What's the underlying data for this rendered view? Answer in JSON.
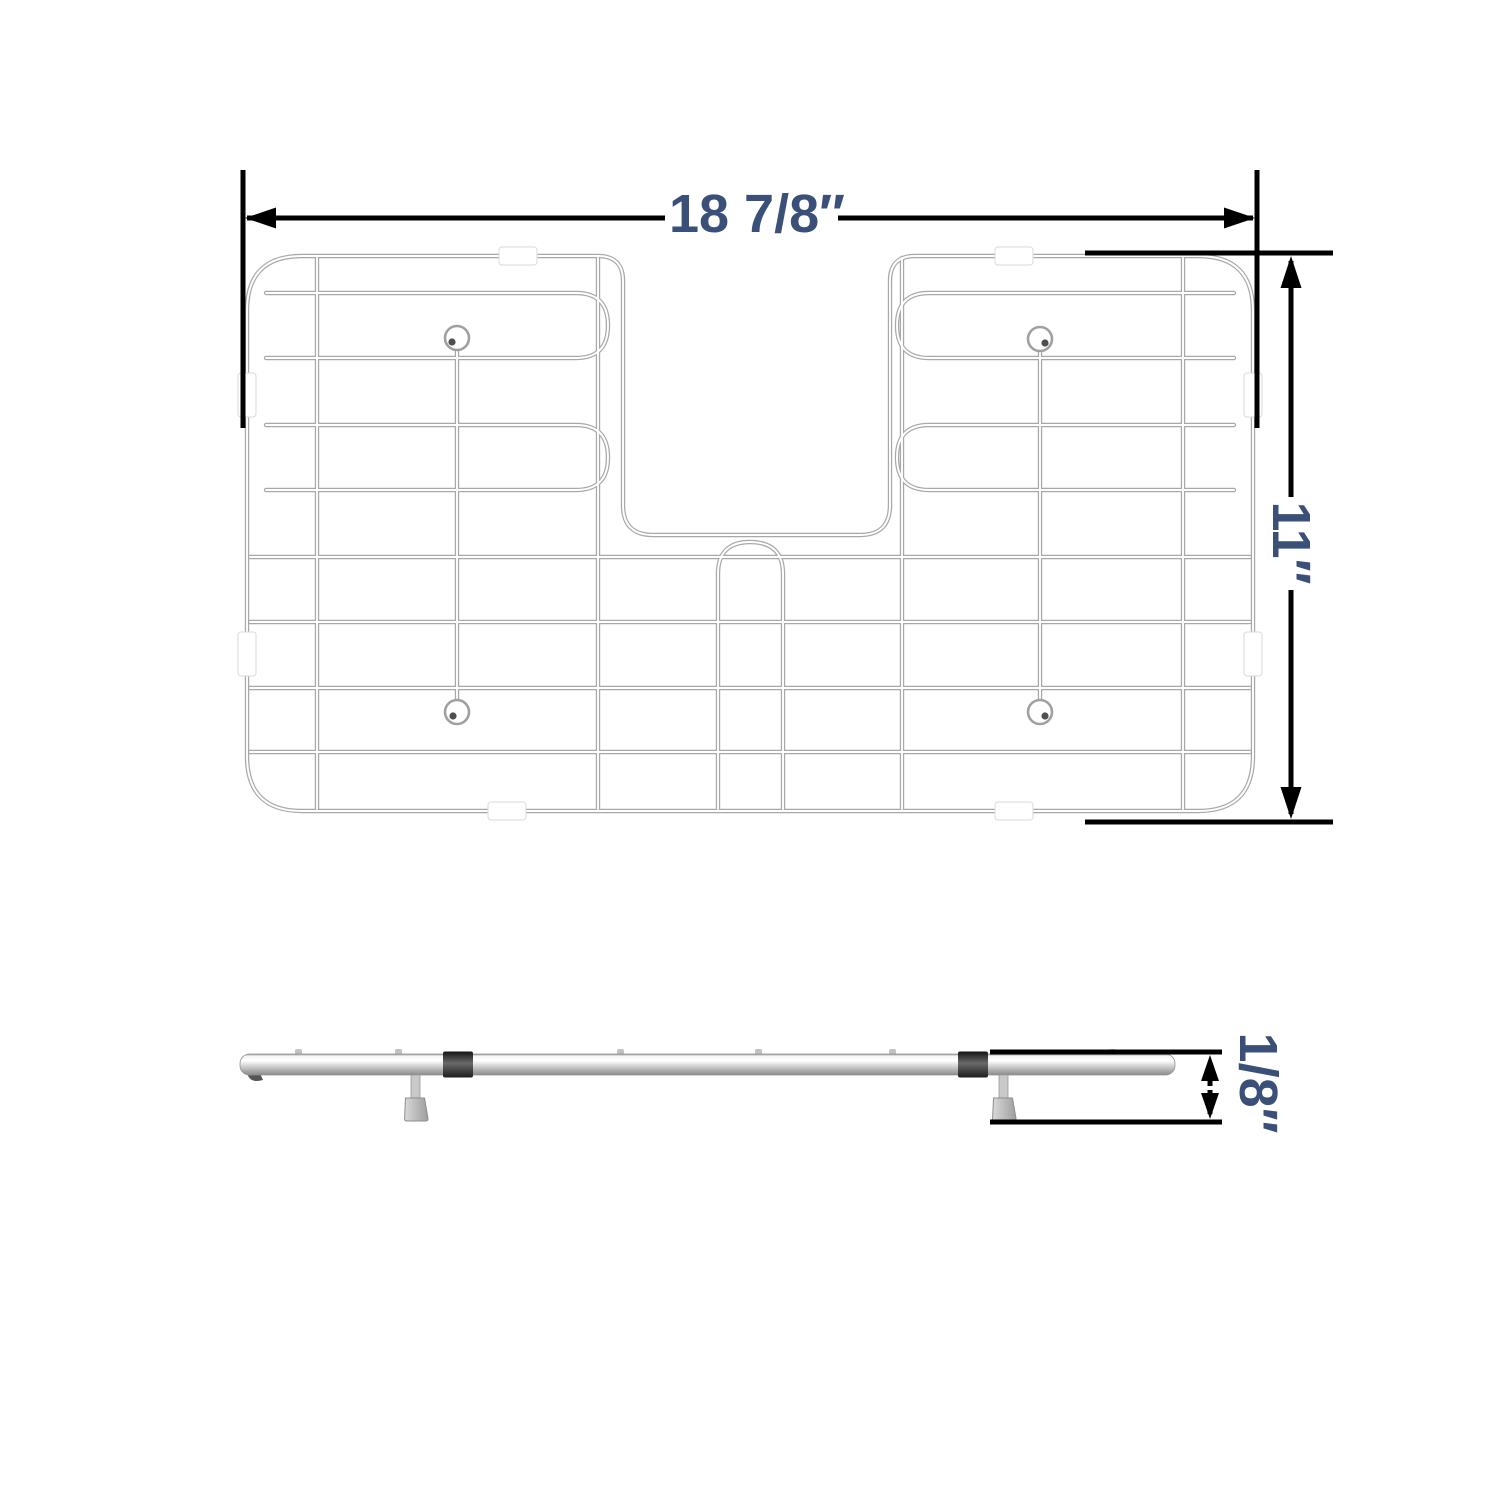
{
  "labels": {
    "width": "18 7/8″",
    "height": "11″",
    "thickness": "1/8″"
  },
  "colors": {
    "dimension_text": "#3a5078",
    "dimension_line": "#000000",
    "wire_outline": "#a8a8a8",
    "wire_core": "#ffffff",
    "clip": "#ffffff",
    "background": "#ffffff"
  }
}
